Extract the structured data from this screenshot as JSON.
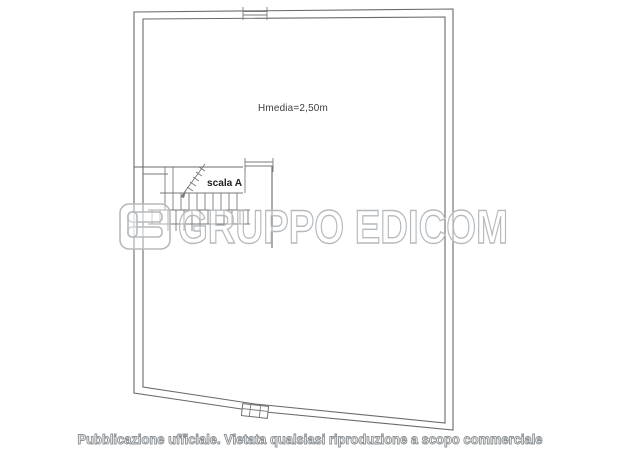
{
  "plan": {
    "height_label": "Hmedia=2,50m",
    "stair_label": "scala A"
  },
  "watermark": {
    "logo_icon": "edicom-logo-icon",
    "text": "GRUPPO EDICOM"
  },
  "footer": {
    "disclaimer": "Pubblicazione ufficiale. Vietata qualsiasi riproduzione a scopo commerciale"
  },
  "colors": {
    "background": "#ffffff",
    "wall_line": "#6a6a6a",
    "watermark_gray": "#b6babd",
    "footer_gray": "#8f9396",
    "label_dark": "#3c3c3c"
  }
}
